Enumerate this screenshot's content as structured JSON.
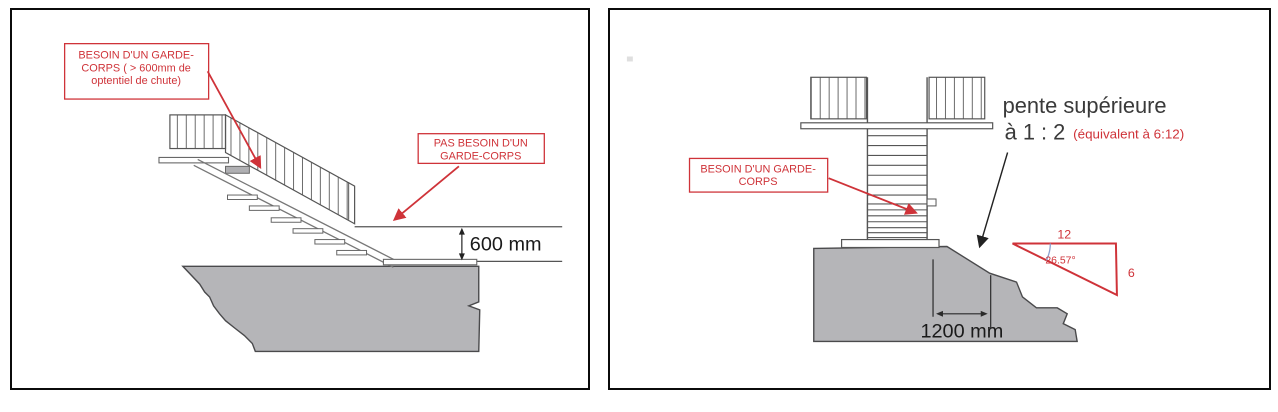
{
  "figure": {
    "description": "Two-panel technical diagram about guardrail (garde-corps) requirements",
    "colors": {
      "annotation_red": "#cf3339",
      "ground_gray_fill": "#b5b5b8",
      "ground_outline": "#4a4a4c",
      "drawing_line": "#555555",
      "dimension_text": "#1a1a1a",
      "slope_text": "#3a3a3a",
      "angle_arc_blue": "#8aa0cf",
      "panel_border": "#0b0b0b"
    }
  },
  "left_panel": {
    "callout_need_guardrail": {
      "lines": [
        "BESOIN D'UN GARDE-",
        "CORPS ( > 600mm de",
        "optentiel de chute)"
      ]
    },
    "callout_no_guardrail": {
      "lines": [
        "PAS BESOIN D'UN",
        "GARDE-CORPS"
      ]
    },
    "drop_dimension_label": "600 mm"
  },
  "right_panel": {
    "callout_need_guardrail": {
      "lines": [
        "BESOIN D'UN GARDE-",
        "CORPS"
      ]
    },
    "slope_note": {
      "title": "pente supérieure",
      "ratio": "à 1 : 2",
      "equivalent": "(équivalent à 6:12)"
    },
    "slope_triangle": {
      "run": "12",
      "rise": "6",
      "angle": "26.57°"
    },
    "width_dimension_label": "1200 mm"
  }
}
